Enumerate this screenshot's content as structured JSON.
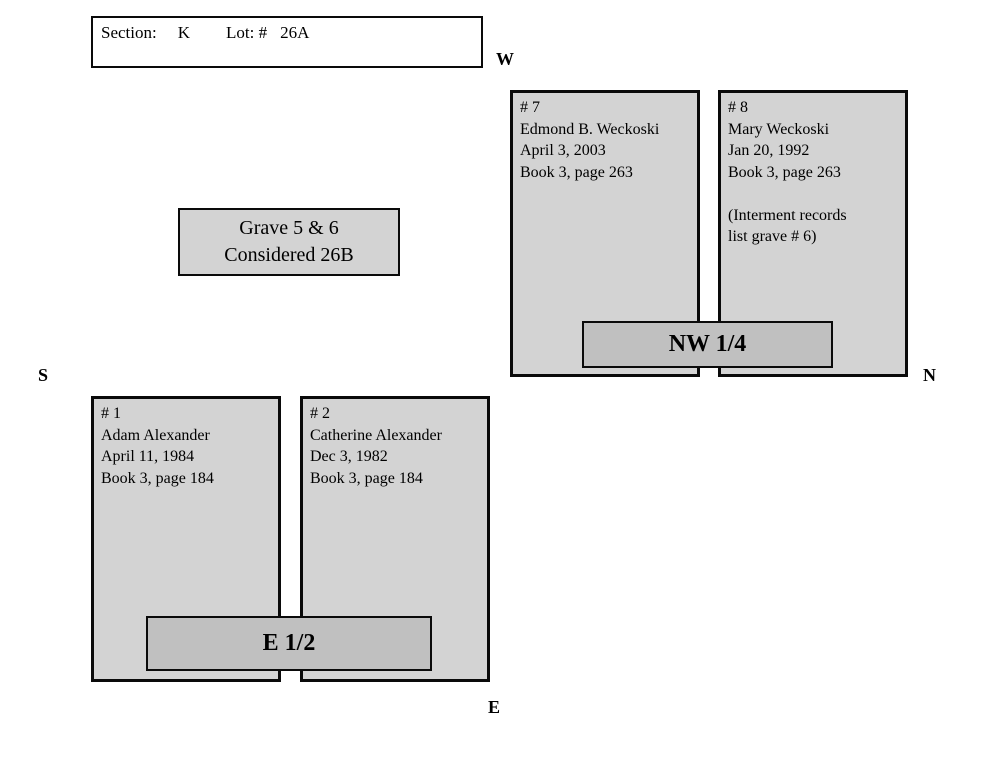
{
  "header": {
    "section_label": "Section:",
    "section_value": "K",
    "lot_label": "Lot: #",
    "lot_value": "26A"
  },
  "compass": {
    "west": "W",
    "north": "N",
    "south": "S",
    "east": "E"
  },
  "note_box": {
    "line1": "Grave 5 & 6",
    "line2": "Considered 26B"
  },
  "plots": {
    "grave7": {
      "lines": [
        "# 7",
        "Edmond B. Weckoski",
        "April 3, 2003",
        "Book 3, page 263"
      ]
    },
    "grave8": {
      "lines": [
        "# 8",
        "Mary Weckoski",
        "Jan 20, 1992",
        "Book 3, page 263",
        "",
        "(Interment records",
        "list grave # 6)"
      ]
    },
    "grave1": {
      "lines": [
        "# 1",
        "Adam Alexander",
        "April 11, 1984",
        "Book 3, page 184"
      ]
    },
    "grave2": {
      "lines": [
        "# 2",
        "Catherine Alexander",
        "Dec 3, 1982",
        "Book 3, page 184"
      ]
    }
  },
  "quarters": {
    "nw": "NW 1/4",
    "e_half": "E 1/2"
  },
  "colors": {
    "page_background": "#ffffff",
    "plot_fill": "#d3d3d3",
    "quarter_fill": "#c0c0c0",
    "border": "#0a0a0a"
  }
}
